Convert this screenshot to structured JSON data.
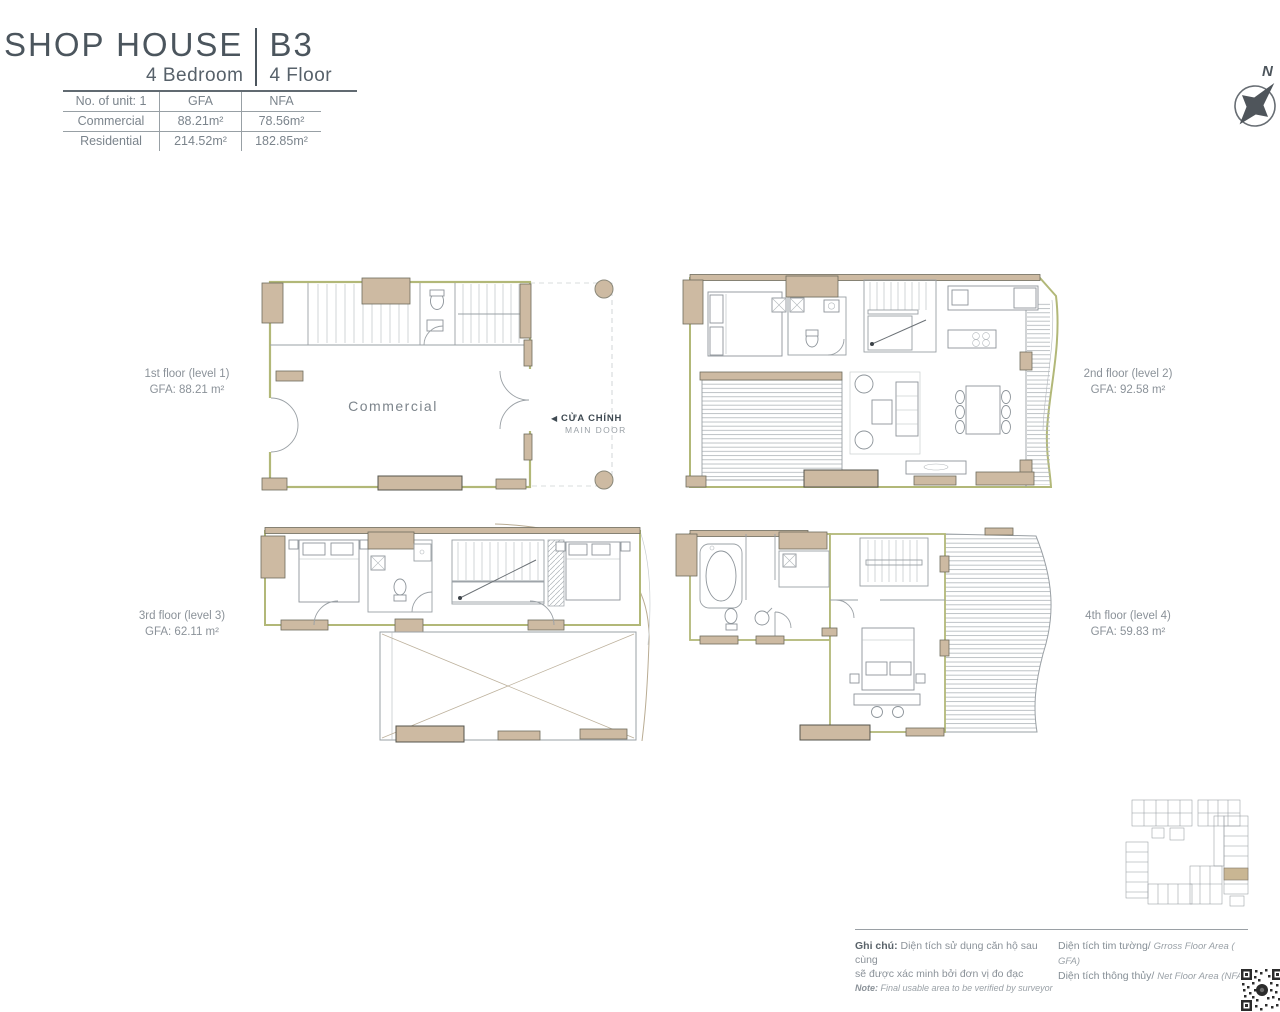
{
  "header": {
    "title": "SHOP HOUSE",
    "unit_code": "B3",
    "bedrooms": "4 Bedroom",
    "floors": "4 Floor",
    "table": {
      "header": [
        "No. of unit: 1",
        "GFA",
        "NFA"
      ],
      "rows": [
        {
          "label": "Commercial",
          "gfa": "88.21m²",
          "nfa": "78.56m²"
        },
        {
          "label": "Residential",
          "gfa": "214.52m²",
          "nfa": "182.85m²"
        }
      ]
    }
  },
  "compass": {
    "north": "N"
  },
  "floor_plans": [
    {
      "name": "1st floor (level 1)",
      "gfa": "GFA: 88.21 m²"
    },
    {
      "name": "2nd floor (level 2)",
      "gfa": "GFA: 92.58 m²"
    },
    {
      "name": "3rd floor (level 3)",
      "gfa": "GFA: 62.11 m²"
    },
    {
      "name": "4th floor (level 4)",
      "gfa": "GFA: 59.83 m²"
    }
  ],
  "plan1": {
    "room_label": "Commercial",
    "main_door_arrow": "◀",
    "main_door_vi": "CỬA CHÍNH",
    "main_door_en": "MAIN DOOR"
  },
  "notes": {
    "ghi_chu_label": "Ghi chú:",
    "ghi_chu_line1": "Diện tích sử dụng căn hộ sau cùng",
    "ghi_chu_line2": "sẽ được xác minh bởi đơn vị đo đạc",
    "note_label": "Note:",
    "note_text": "Final usable area to be verified by surveyor",
    "gfa_vi": "Diện tích tim tường/",
    "gfa_en": "Grross Floor Area ( GFA)",
    "nfa_vi": "Diện tích thông thủy/",
    "nfa_en": "Net Floor Area (NFA)"
  },
  "colors": {
    "wall_tan": "#cdbaa2",
    "wall_olive": "#b2b878",
    "accent_dark": "#4b555d",
    "text_gray": "#8b9299"
  }
}
